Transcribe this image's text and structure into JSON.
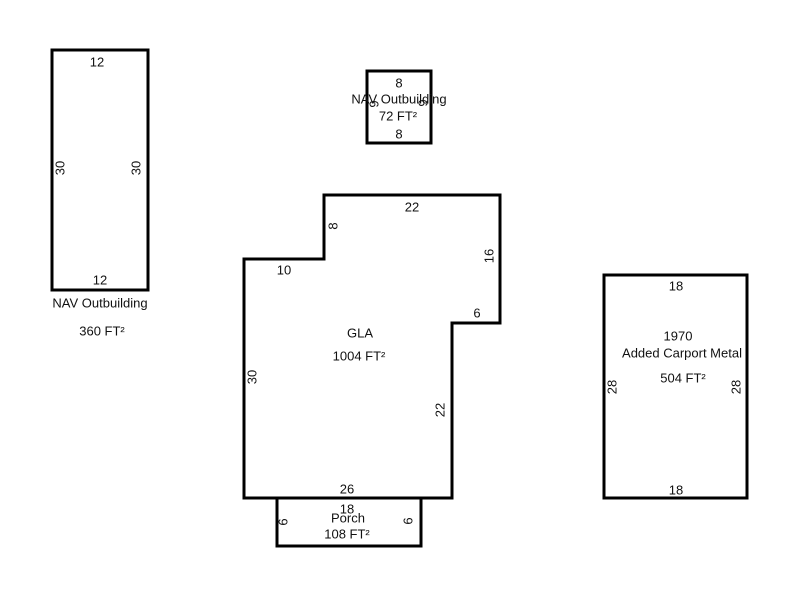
{
  "diagram": {
    "kind": "appraisal-sketch-floorplan",
    "background_color": "#ffffff",
    "line_color": "#000000",
    "text_color": "#111111"
  },
  "outbuilding_large": {
    "title": "NAV Outbuilding",
    "area": "360 FT²",
    "dims": {
      "top": "12",
      "left": "30",
      "right": "30",
      "bottom": "12"
    }
  },
  "outbuilding_small": {
    "title": "NAV Outbuilding",
    "area": "72 FT²",
    "dims": {
      "top": "8",
      "left": "9",
      "right": "9",
      "bottom": "8"
    }
  },
  "gla": {
    "title": "GLA",
    "area": "1004 FT²",
    "dims": {
      "top": "22",
      "upper_left": "8",
      "step": "10",
      "upper_right": "16",
      "notch": "6",
      "left": "30",
      "lower_right": "22",
      "bottom": "26"
    }
  },
  "porch": {
    "title": "Porch",
    "area": "108 FT²",
    "dims": {
      "top": "18",
      "left": "6",
      "right": "6"
    }
  },
  "carport": {
    "year": "1970",
    "title": "Added Carport Metal",
    "area": "504 FT²",
    "dims": {
      "top": "18",
      "left": "28",
      "right": "28",
      "bottom": "18"
    }
  }
}
